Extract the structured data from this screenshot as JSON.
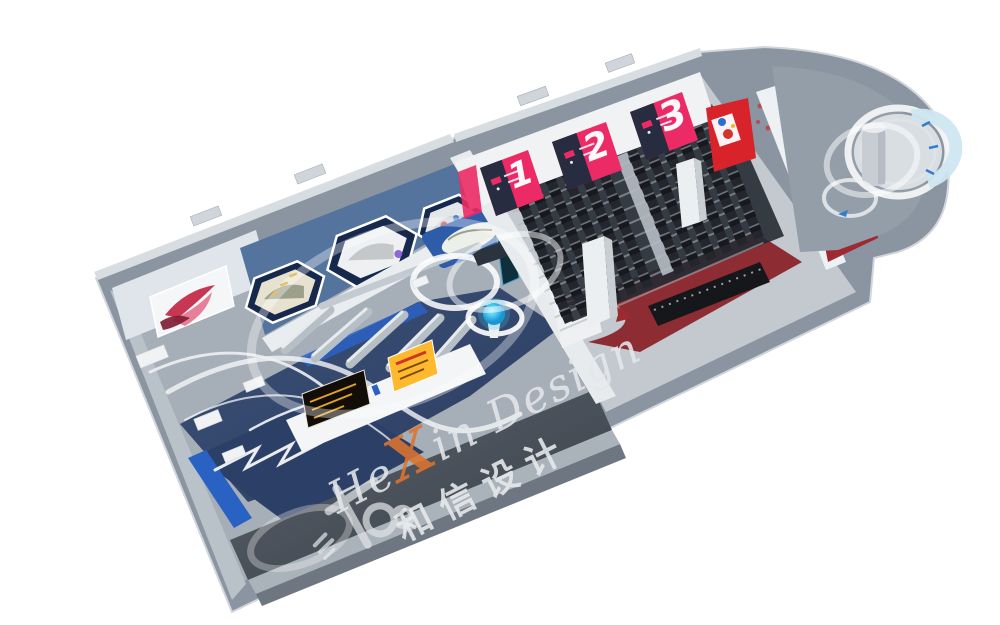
{
  "scene": {
    "description": "3D bird's-eye rendering of an exhibition hall interior design",
    "background": "#ffffff"
  },
  "watermark": {
    "script_pre": "He",
    "script_x": "X",
    "script_post": "in Design",
    "chinese": "和信设计",
    "script_color": "#E4E8EB",
    "x_color": "#DD7430"
  },
  "auditorium": {
    "banners": [
      {
        "number": "1"
      },
      {
        "number": "2"
      },
      {
        "number": "3"
      }
    ],
    "banner_pink": "#EC2A66",
    "banner_navy": "#282C40",
    "seat_rows": 10,
    "seat_cols": 13,
    "aisle_col": 6,
    "seat_color": "#17191E",
    "seat_cushion": "#23262C",
    "carpet_color": "#8D2D33",
    "column_count": 2
  },
  "left_hall": {
    "hex_displays": 3,
    "wall_blue": "#54749E",
    "hex_frame_navy": "#16294D",
    "floor_navy": "#33476B",
    "accent_blue": "#2A62C4",
    "sphere_cyan": "#35C2F0",
    "gold_board": "#F6B42E"
  },
  "right_room": {
    "green_panel": "#1FA845",
    "red_panel": "#D8232A",
    "crimson_wall": "#9E2933"
  },
  "shell": {
    "outer_wall": "#8A95A1",
    "wall_cap": "#D8DDE2",
    "floor_gray": "#A6AEB7"
  }
}
